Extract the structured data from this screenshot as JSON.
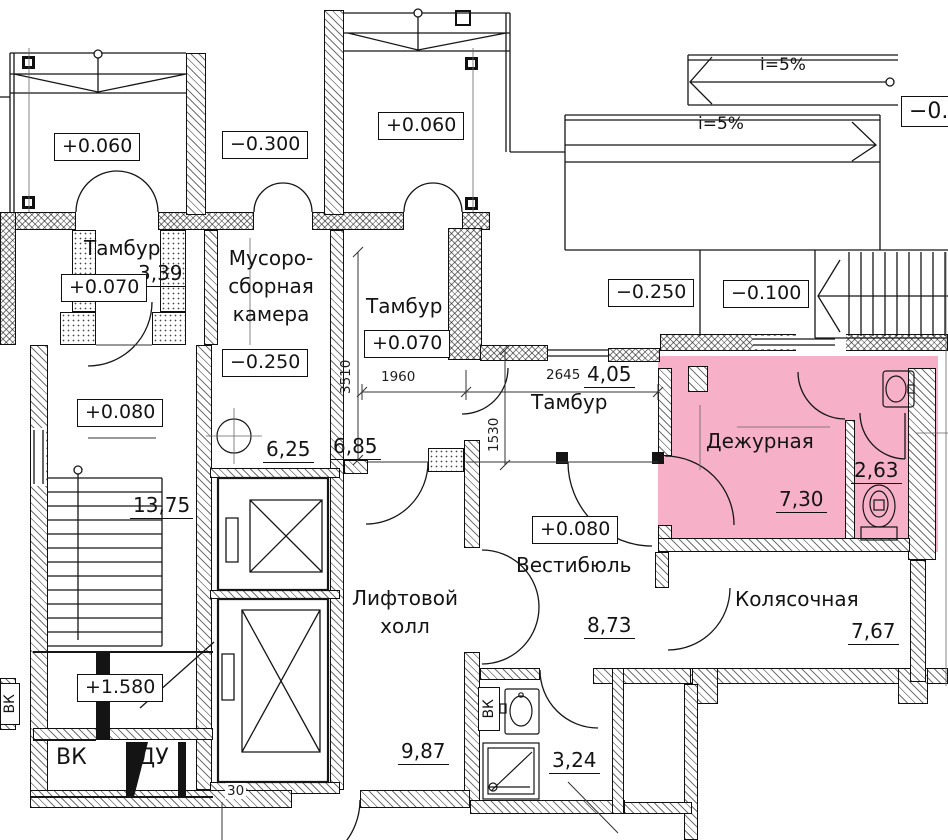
{
  "plan": {
    "colors": {
      "highlight": "#f6b0c7",
      "line": "#141414"
    },
    "rooms": {
      "tambur1": {
        "name": "Тамбур",
        "area": "3,39"
      },
      "musoro": {
        "l1": "Мусоро-",
        "l2": "сборная",
        "l3": "камера",
        "area": "6,25"
      },
      "tambur2": {
        "name": "Тамбур",
        "area": "6,85"
      },
      "tambur3": {
        "name": "Тамбур",
        "area": "4,05"
      },
      "dezhurnaya": {
        "name": "Дежурная",
        "area": "7,30"
      },
      "san": {
        "area": "2,63"
      },
      "vestibul": {
        "name": "Вестибюль",
        "area": "8,73"
      },
      "kolyaso": {
        "name": "Колясочная",
        "area": "7,67"
      },
      "lift": {
        "l1": "Лифтовой",
        "l2": "холл",
        "area": "9,87"
      },
      "stairwell": {
        "area": "13,75"
      },
      "vk_room": {
        "name": "ВК"
      },
      "du_room": {
        "name": "ДУ"
      },
      "vk_shaft_bottom": {
        "name": "ВК",
        "area": "3,24"
      },
      "vk_shaft_left": {
        "name": "ВК"
      }
    },
    "elevations": {
      "porch1": "+0.060",
      "porch2": "−0.300",
      "porch3": "+0.060",
      "tambur1": "+0.070",
      "musoro": "−0.250",
      "tambur2": "+0.070",
      "yard": "−0.250",
      "entry_landing": "−0.100",
      "edge_clipped": "−0.",
      "stair": "+0.080",
      "vestibul": "+0.080",
      "mezzanine": "+1.580"
    },
    "slopes": {
      "ramp_top": "i=5%",
      "ramp_main": "i=5%"
    },
    "dims": {
      "w1": "1960",
      "w2": "2645",
      "h1": "1530",
      "h2": "3510",
      "t1": "30"
    }
  }
}
